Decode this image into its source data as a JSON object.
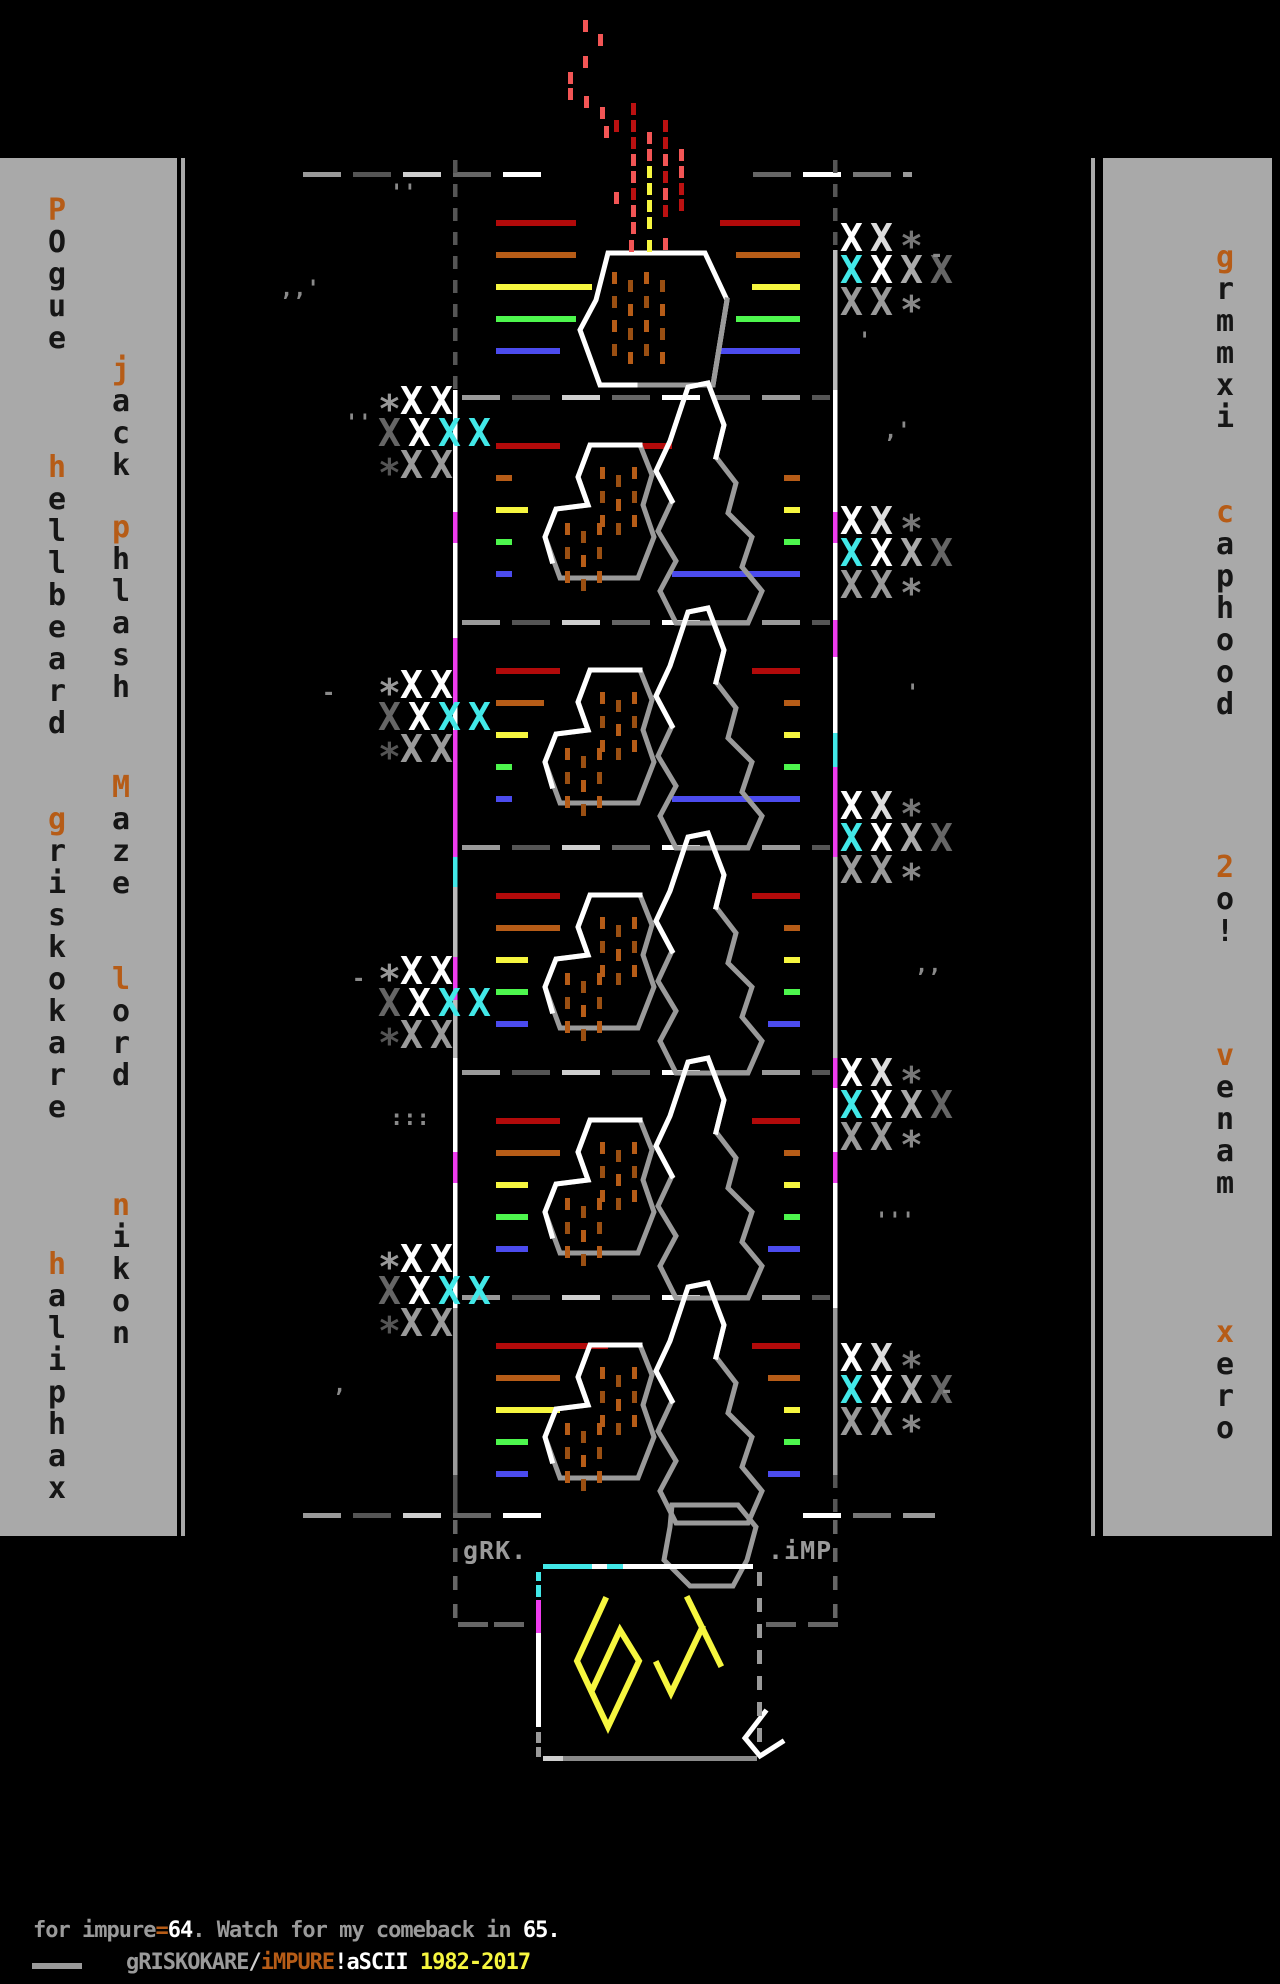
{
  "title": "gRISKOKARE iMPURE 64 ascii artwork",
  "palette": {
    "bg": "#000000",
    "bar": "#a9a9a9",
    "letter": "#161616",
    "orange": "#b65c17",
    "white": "#ffffff",
    "gray_light": "#cfcfcf",
    "gray": "#9a9a9a",
    "gray_mid": "#777777",
    "gray_dark": "#555555",
    "red": "#b20a0a",
    "red_bright": "#f25555",
    "red_deep": "#bb1111",
    "yellow": "#f6f63f",
    "green": "#4df64d",
    "blue": "#4b4bee",
    "magenta": "#ee3cee",
    "cyan": "#42e8e8"
  },
  "left_bar": {
    "columns": [
      {
        "x": 41,
        "names": [
          {
            "text": "POgue",
            "y": 196
          },
          {
            "text": "hellbeard",
            "y": 453
          },
          {
            "text": "griskokare",
            "y": 805
          },
          {
            "text": "haliphax",
            "y": 1250
          }
        ]
      },
      {
        "x": 105,
        "names": [
          {
            "text": "jack",
            "y": 355
          },
          {
            "text": "phlash",
            "y": 513
          },
          {
            "text": "Maze",
            "y": 773
          },
          {
            "text": "lord",
            "y": 965
          },
          {
            "text": "nikon",
            "y": 1191
          }
        ]
      }
    ]
  },
  "right_bar": {
    "columns": [
      {
        "x": 1209,
        "names": [
          {
            "text": "grmmxi",
            "y": 243
          },
          {
            "text": "caphood",
            "y": 498
          },
          {
            "text": "2o!",
            "y": 853
          },
          {
            "text": "venam",
            "y": 1041
          },
          {
            "text": "xero",
            "y": 1318
          }
        ]
      }
    ]
  },
  "panel": {
    "grk_label": "gRK.",
    "imp_label": ".iMP"
  },
  "logo": {
    "text": "64"
  },
  "footer": {
    "line1": [
      {
        "t": "for impure",
        "c": "gray"
      },
      {
        "t": "=",
        "c": "orange"
      },
      {
        "t": "64",
        "c": "white"
      },
      {
        "t": ". Watch for my comeback in ",
        "c": "gray"
      },
      {
        "t": "65.",
        "c": "white"
      }
    ],
    "line2": [
      {
        "t": "gRISKOKARE",
        "c": "gray"
      },
      {
        "t": "/",
        "c": "gray_light"
      },
      {
        "t": "iMPURE",
        "c": "orange"
      },
      {
        "t": "!",
        "c": "white"
      },
      {
        "t": "aSCII ",
        "c": "white"
      },
      {
        "t": "1982-2017",
        "c": "yellow"
      }
    ]
  },
  "motifs": [
    {
      "y": 172,
      "left": [
        80,
        80,
        96,
        80,
        64
      ],
      "right": [
        [
          80,
          800
        ],
        [
          64,
          800
        ],
        [
          48,
          800
        ],
        [
          64,
          800
        ],
        [
          80,
          800
        ]
      ],
      "type": "small"
    },
    {
      "y": 395,
      "left": [
        64,
        16,
        32,
        16,
        16
      ],
      "right": [
        [
          32,
          672
        ],
        [
          16,
          800
        ],
        [
          16,
          800
        ],
        [
          16,
          800
        ],
        [
          128,
          800
        ]
      ],
      "type": "double"
    },
    {
      "y": 620,
      "left": [
        64,
        48,
        32,
        16,
        16
      ],
      "right": [
        [
          48,
          800
        ],
        [
          16,
          800
        ],
        [
          16,
          800
        ],
        [
          16,
          800
        ],
        [
          128,
          800
        ]
      ],
      "type": "double"
    },
    {
      "y": 845,
      "left": [
        64,
        64,
        32,
        32,
        32
      ],
      "right": [
        [
          48,
          800
        ],
        [
          16,
          800
        ],
        [
          16,
          800
        ],
        [
          16,
          800
        ],
        [
          32,
          800
        ]
      ],
      "type": "double"
    },
    {
      "y": 1070,
      "left": [
        64,
        64,
        32,
        32,
        32
      ],
      "right": [
        [
          48,
          800
        ],
        [
          16,
          800
        ],
        [
          16,
          800
        ],
        [
          16,
          800
        ],
        [
          32,
          800
        ]
      ],
      "type": "double"
    },
    {
      "y": 1295,
      "left": [
        112,
        64,
        64,
        32,
        32
      ],
      "right": [
        [
          48,
          800
        ],
        [
          32,
          800
        ],
        [
          16,
          800
        ],
        [
          16,
          800
        ],
        [
          32,
          800
        ]
      ],
      "type": "double"
    }
  ],
  "line_colors": [
    "red",
    "orange",
    "yellow",
    "green",
    "blue"
  ],
  "cluster_rows": {
    "L": [
      [
        [
          "*",
          "#999999"
        ],
        [
          "X",
          "#ffffff"
        ],
        [
          "X",
          "#ffffff"
        ]
      ],
      [
        [
          "X",
          "#666666"
        ],
        [
          "X",
          "#ffffff"
        ],
        [
          "X",
          "#42e8e8"
        ],
        [
          "X",
          "#42e8e8"
        ]
      ],
      [
        [
          "*",
          "#555555"
        ],
        [
          "X",
          "#9a9a9a"
        ],
        [
          "X",
          "#9a9a9a"
        ]
      ]
    ],
    "R": [
      [
        [
          "X",
          "#ffffff"
        ],
        [
          "X",
          "#dddddd"
        ],
        [
          "*",
          "#777777"
        ]
      ],
      [
        [
          "X",
          "#42e8e8"
        ],
        [
          "X",
          "#ffffff"
        ],
        [
          "X",
          "#aaaaaa"
        ],
        [
          "X",
          "#666666"
        ]
      ],
      [
        [
          "X",
          "#9a9a9a"
        ],
        [
          "X",
          "#9a9a9a"
        ],
        [
          "*",
          "#888888"
        ]
      ]
    ]
  },
  "clusters": [
    {
      "side": "L",
      "x": 378,
      "y": 388
    },
    {
      "side": "L",
      "x": 378,
      "y": 672
    },
    {
      "side": "L",
      "x": 378,
      "y": 958
    },
    {
      "side": "L",
      "x": 378,
      "y": 1246
    },
    {
      "side": "R",
      "x": 840,
      "y": 225
    },
    {
      "side": "R",
      "x": 840,
      "y": 508
    },
    {
      "side": "R",
      "x": 840,
      "y": 793
    },
    {
      "side": "R",
      "x": 840,
      "y": 1060
    },
    {
      "side": "R",
      "x": 840,
      "y": 1345
    }
  ],
  "smoke": [
    [
      583,
      20,
      "rb"
    ],
    [
      598,
      34,
      "rb"
    ],
    [
      583,
      56,
      "rb"
    ],
    [
      568,
      72,
      "rb"
    ],
    [
      568,
      88,
      "rb"
    ],
    [
      584,
      96,
      "rb"
    ],
    [
      600,
      107,
      "rb"
    ],
    [
      614,
      120,
      "rd"
    ],
    [
      604,
      126,
      "rb"
    ],
    [
      614,
      192,
      "rb"
    ],
    [
      631,
      103,
      "rd"
    ],
    [
      631,
      120,
      "rd"
    ],
    [
      631,
      137,
      "rd"
    ],
    [
      631,
      154,
      "rb"
    ],
    [
      631,
      171,
      "rb"
    ],
    [
      631,
      188,
      "rd"
    ],
    [
      631,
      205,
      "rb"
    ],
    [
      631,
      222,
      "rb"
    ],
    [
      647,
      132,
      "rb"
    ],
    [
      647,
      149,
      "rb"
    ],
    [
      647,
      166,
      "y"
    ],
    [
      647,
      183,
      "y"
    ],
    [
      647,
      200,
      "y"
    ],
    [
      647,
      217,
      "y"
    ],
    [
      663,
      120,
      "rd"
    ],
    [
      663,
      137,
      "rd"
    ],
    [
      663,
      154,
      "rb"
    ],
    [
      663,
      171,
      "rd"
    ],
    [
      663,
      188,
      "rb"
    ],
    [
      663,
      205,
      "rd"
    ],
    [
      679,
      149,
      "rb"
    ],
    [
      679,
      166,
      "rb"
    ],
    [
      679,
      183,
      "rd"
    ],
    [
      679,
      199,
      "rd"
    ],
    [
      629,
      240,
      "rb"
    ],
    [
      647,
      240,
      "y"
    ],
    [
      663,
      238,
      "rb"
    ]
  ],
  "specks": [
    [
      280,
      296,
      ",,'"
    ],
    [
      390,
      200,
      "''"
    ],
    [
      345,
      430,
      "''"
    ],
    [
      322,
      700,
      "-"
    ],
    [
      352,
      986,
      "-"
    ],
    [
      390,
      1125,
      ":::"
    ],
    [
      333,
      1392,
      ","
    ],
    [
      930,
      262,
      "-"
    ],
    [
      858,
      348,
      "'"
    ],
    [
      884,
      438,
      ",'"
    ],
    [
      906,
      700,
      "'"
    ],
    [
      915,
      972,
      ",,"
    ],
    [
      875,
      1228,
      "'''"
    ],
    [
      940,
      1398,
      "-"
    ]
  ],
  "borders": {
    "left": [
      {
        "y": 160,
        "h": 230,
        "c": "dash"
      },
      {
        "y": 390,
        "h": 122,
        "c": "#ffffff"
      },
      {
        "y": 512,
        "h": 31,
        "c": "#ee3cee"
      },
      {
        "y": 543,
        "h": 95,
        "c": "#ffffff"
      },
      {
        "y": 638,
        "h": 67,
        "c": "#ee3cee"
      },
      {
        "y": 705,
        "h": 25,
        "c": "#ffffff"
      },
      {
        "y": 730,
        "h": 127,
        "c": "#ee3cee"
      },
      {
        "y": 857,
        "h": 30,
        "c": "#42e8e8"
      },
      {
        "y": 887,
        "h": 70,
        "c": "#bbbbbb"
      },
      {
        "y": 957,
        "h": 43,
        "c": "#ee3cee"
      },
      {
        "y": 1000,
        "h": 58,
        "c": "#bbbbbb"
      },
      {
        "y": 1058,
        "h": 94,
        "c": "#ffffff"
      },
      {
        "y": 1152,
        "h": 31,
        "c": "#ee3cee"
      },
      {
        "y": 1183,
        "h": 125,
        "c": "#ffffff"
      },
      {
        "y": 1308,
        "h": 167,
        "c": "#9a9a9a"
      },
      {
        "y": 1475,
        "h": 38,
        "c": "#555555"
      }
    ],
    "right": [
      {
        "y": 160,
        "h": 90,
        "c": "dash"
      },
      {
        "y": 250,
        "h": 140,
        "c": "#bbbbbb"
      },
      {
        "y": 390,
        "h": 122,
        "c": "#ffffff"
      },
      {
        "y": 512,
        "h": 31,
        "c": "#ee3cee"
      },
      {
        "y": 543,
        "h": 77,
        "c": "#ffffff"
      },
      {
        "y": 620,
        "h": 37,
        "c": "#ee3cee"
      },
      {
        "y": 657,
        "h": 76,
        "c": "#ffffff"
      },
      {
        "y": 733,
        "h": 34,
        "c": "#42e8e8"
      },
      {
        "y": 767,
        "h": 90,
        "c": "#ee3cee"
      },
      {
        "y": 857,
        "h": 201,
        "c": "#bbbbbb"
      },
      {
        "y": 1058,
        "h": 30,
        "c": "#ee3cee"
      },
      {
        "y": 1088,
        "h": 64,
        "c": "#ffffff"
      },
      {
        "y": 1152,
        "h": 31,
        "c": "#ee3cee"
      },
      {
        "y": 1183,
        "h": 125,
        "c": "#ffffff"
      },
      {
        "y": 1308,
        "h": 167,
        "c": "#9a9a9a"
      },
      {
        "y": 1475,
        "h": 38,
        "c": "dash"
      }
    ]
  },
  "separators": [
    {
      "y": 172,
      "x0": 303,
      "x1": 912,
      "gaps": [
        [
          590,
          705
        ]
      ]
    },
    {
      "y": 395,
      "x0": 462,
      "x1": 830,
      "gaps": []
    },
    {
      "y": 620,
      "x0": 462,
      "x1": 830,
      "gaps": []
    },
    {
      "y": 845,
      "x0": 462,
      "x1": 830,
      "gaps": []
    },
    {
      "y": 1070,
      "x0": 462,
      "x1": 830,
      "gaps": []
    },
    {
      "y": 1295,
      "x0": 462,
      "x1": 830,
      "gaps": []
    },
    {
      "y": 1513,
      "x0": 303,
      "x1": 935,
      "gaps": [
        [
          548,
          758
        ]
      ]
    }
  ]
}
